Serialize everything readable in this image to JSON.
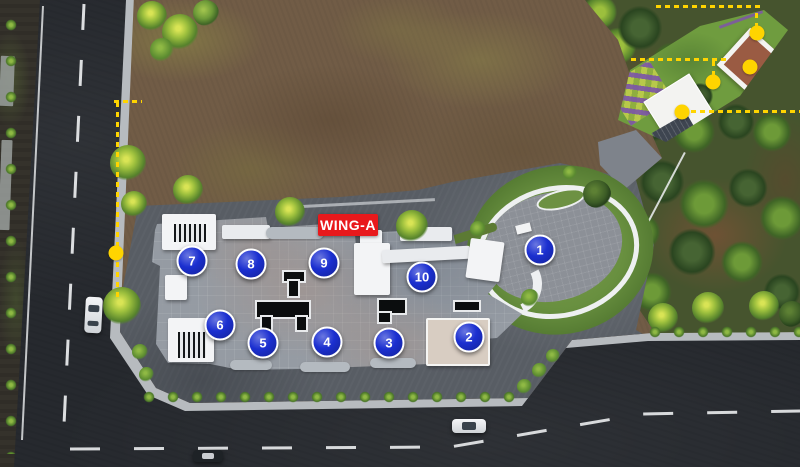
{
  "site": {
    "wing_label": "WING-A",
    "markers": [
      {
        "number": "1",
        "x": 540,
        "y": 250
      },
      {
        "number": "2",
        "x": 469,
        "y": 337
      },
      {
        "number": "3",
        "x": 389,
        "y": 343
      },
      {
        "number": "4",
        "x": 327,
        "y": 342
      },
      {
        "number": "5",
        "x": 263,
        "y": 343
      },
      {
        "number": "6",
        "x": 220,
        "y": 325
      },
      {
        "number": "7",
        "x": 192,
        "y": 261
      },
      {
        "number": "8",
        "x": 251,
        "y": 264
      },
      {
        "number": "9",
        "x": 324,
        "y": 263
      },
      {
        "number": "10",
        "x": 422,
        "y": 277
      }
    ],
    "amenity_dots": [
      {
        "x": 757,
        "y": 33
      },
      {
        "x": 750,
        "y": 67
      },
      {
        "x": 713,
        "y": 82
      },
      {
        "x": 682,
        "y": 112
      },
      {
        "x": 116,
        "y": 253
      }
    ],
    "colors": {
      "marker": "#1b2fd0",
      "wing_bg": "#e8191c",
      "boundary": "#ffd400"
    }
  }
}
